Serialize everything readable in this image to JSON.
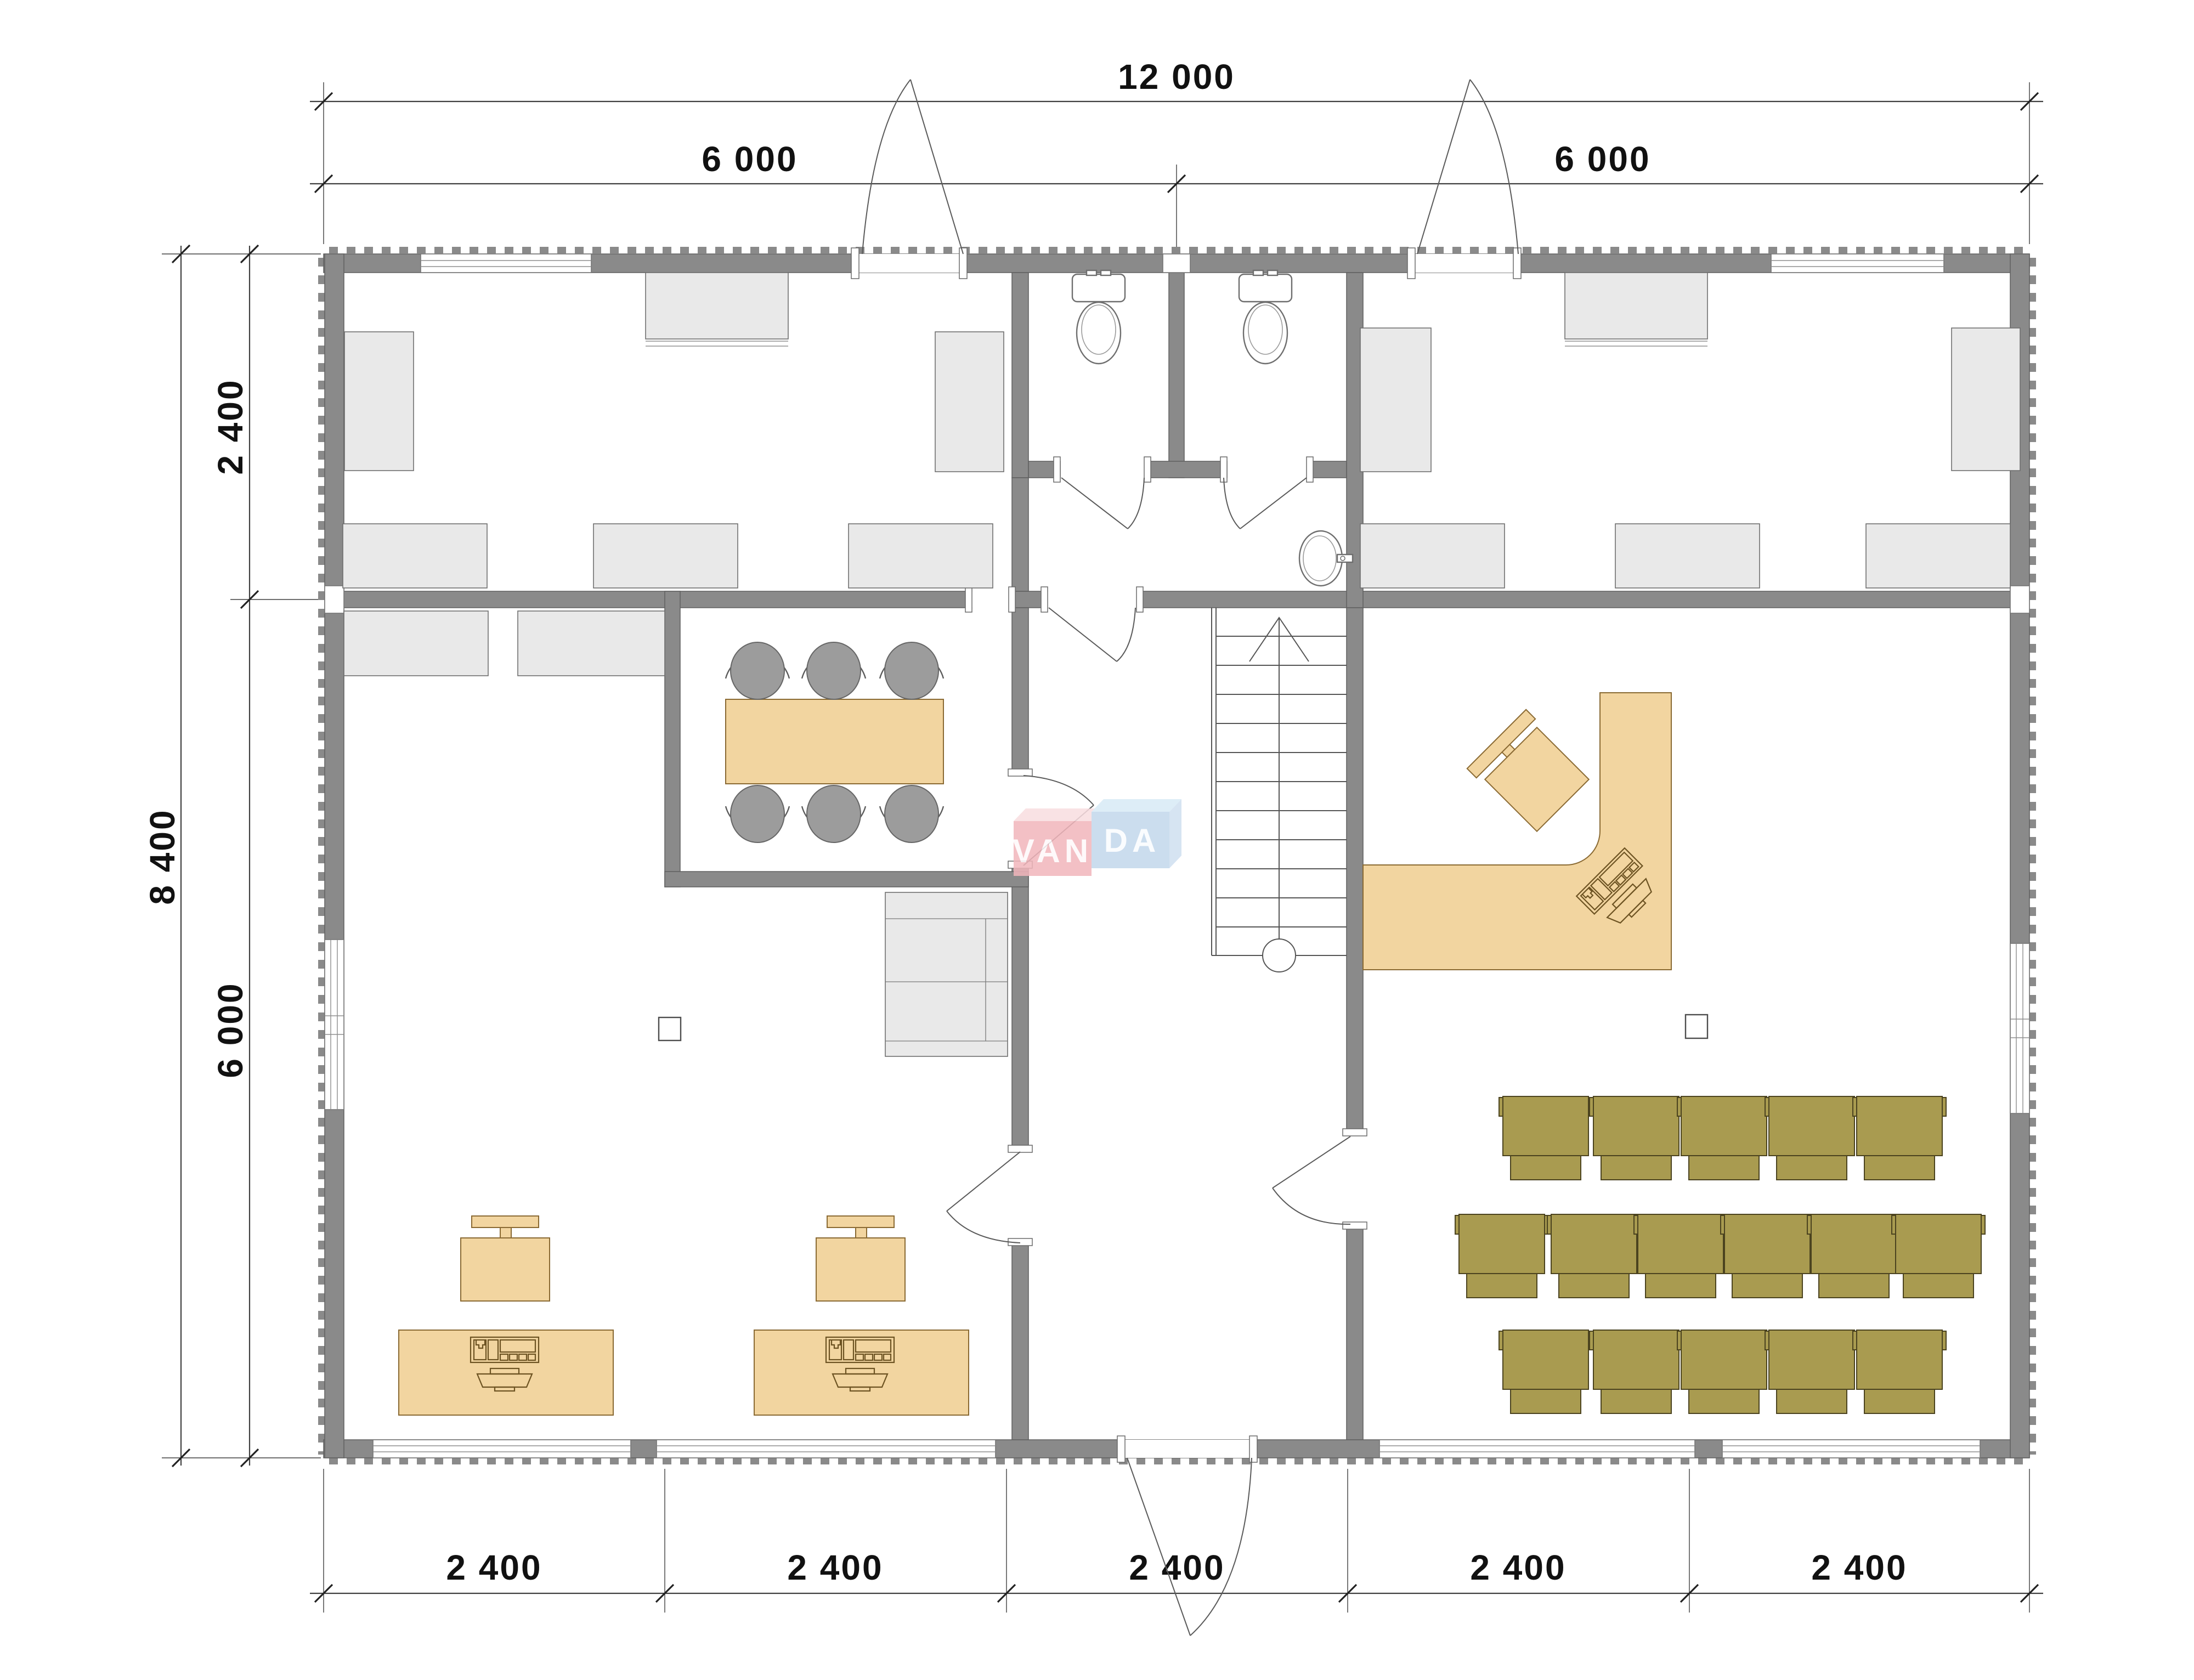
{
  "drawing": {
    "type": "architectural-floor-plan",
    "dimensions": {
      "horizontal_top": {
        "total": "12 000",
        "half_left": "6 000",
        "half_right": "6 000"
      },
      "vertical_left": {
        "total": "8 400",
        "upper": "2 400",
        "lower": "6 000"
      },
      "horizontal_bottom": {
        "segments": [
          "2 400",
          "2 400",
          "2 400",
          "2 400",
          "2 400"
        ]
      }
    },
    "watermark": {
      "text": "VANDA",
      "left_block": "VAN",
      "right_block": "DA"
    },
    "colors": {
      "walls": "#8a8a8a",
      "furniture_gray": "#e9e9e9",
      "furniture_wood": "#f2d5a0",
      "seating_olive": "#a99b50",
      "chair_gray": "#9c9c9c",
      "watermark_pink": "#f2b6bc",
      "watermark_blue": "#c3d8ec",
      "watermark_top_light": "#d8eaf6"
    },
    "icons": {
      "toilet": "toilet-icon",
      "sink": "sink-icon",
      "stairs": "stairs-icon",
      "door_swing": "door-arc-icon",
      "office_chair": "office-chair-icon",
      "auditorium_chair": "auditorium-chair-icon",
      "meeting_chair": "meeting-chair-icon",
      "meeting_table": "meeting-table-icon",
      "reception_desk": "reception-desk-icon",
      "computer_workstation": "computer-icon",
      "window": "window-icon"
    }
  }
}
